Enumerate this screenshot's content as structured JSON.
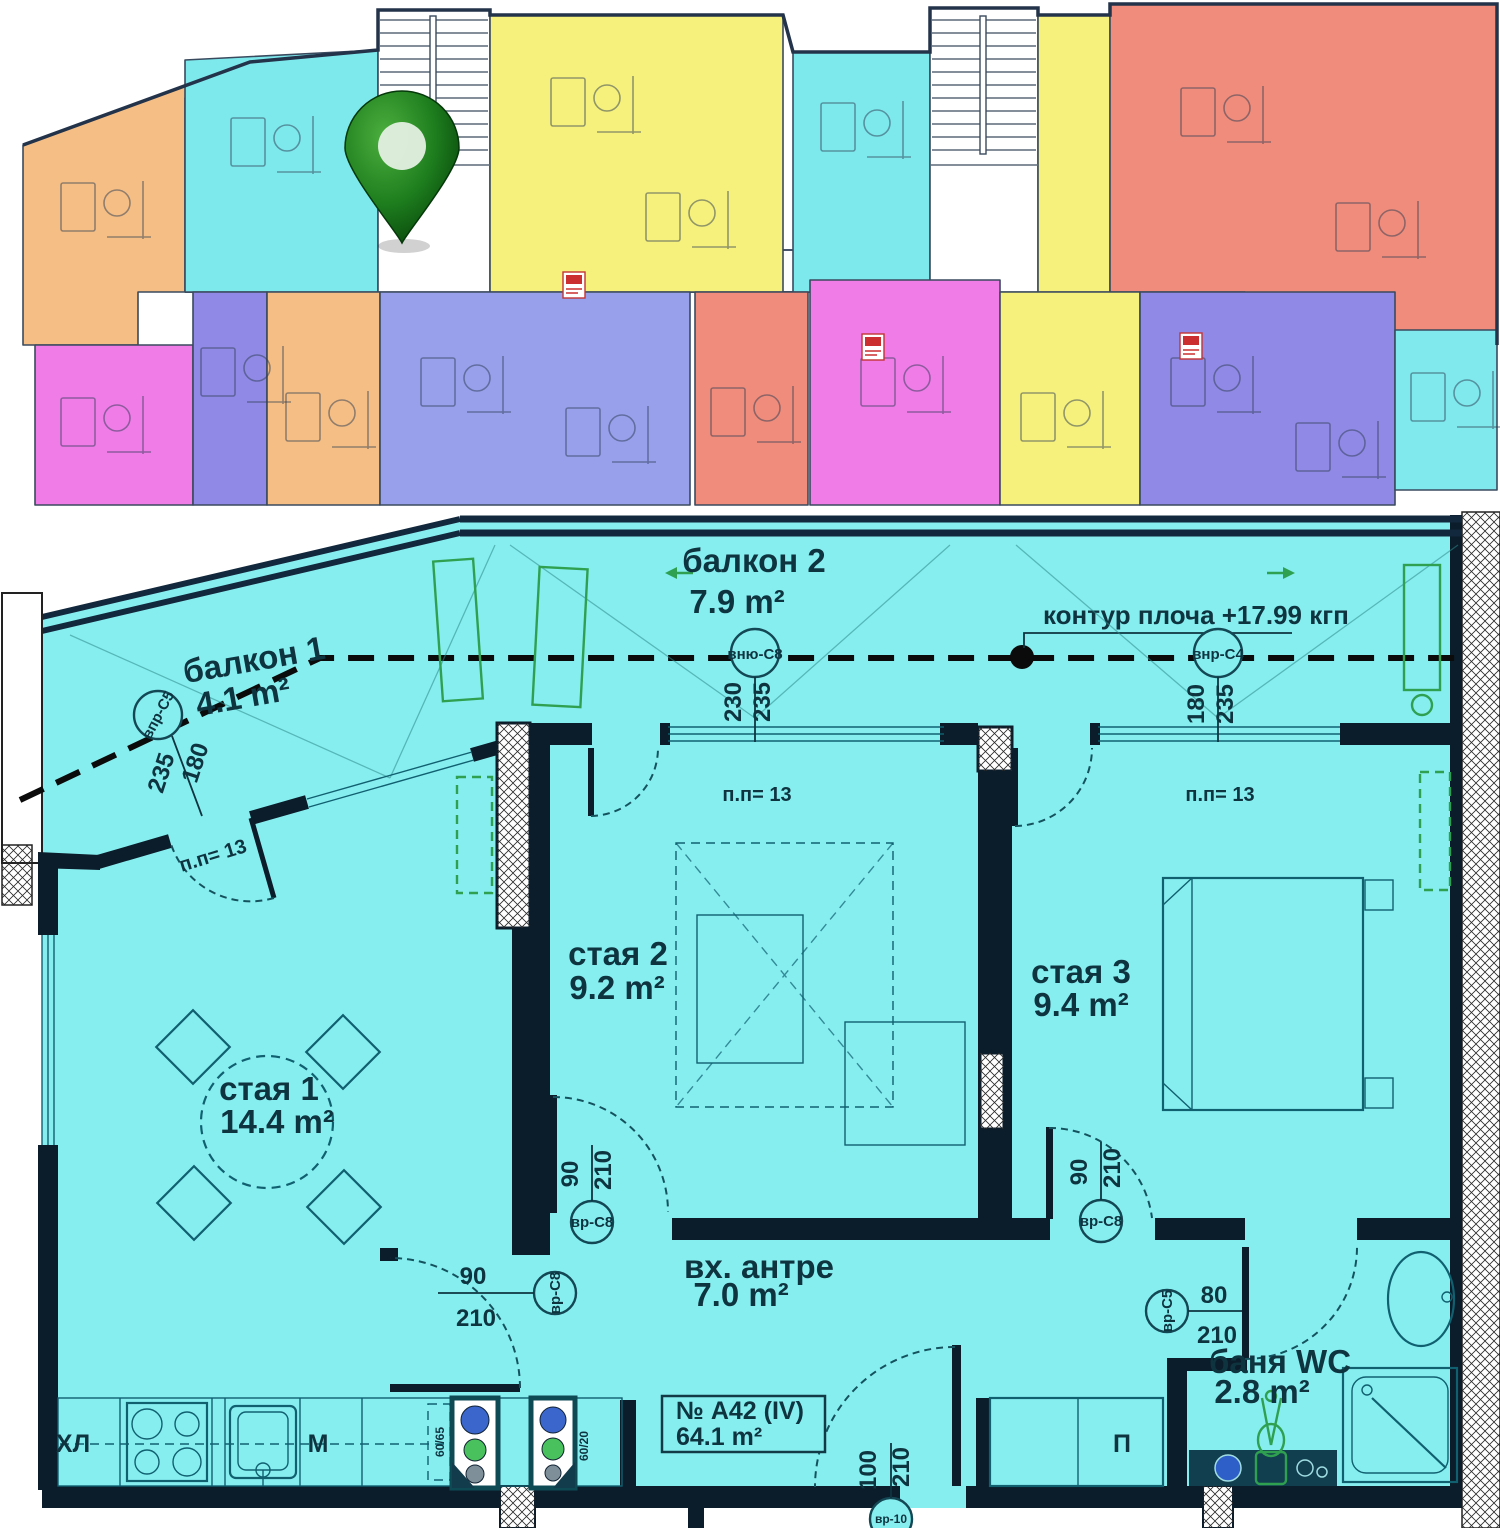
{
  "overview": {
    "colors": {
      "orange": "#F5BE85",
      "cyan": "#7EE9ED",
      "yellow": "#F6F17D",
      "salmon": "#F08C7B",
      "magenta": "#F07CE8",
      "purple": "#9089E6",
      "blue": "#98A0EC",
      "teal_right": "#7FE9ED"
    },
    "pin": {
      "name": "location-pin",
      "color": "#1E7E1E"
    }
  },
  "plan": {
    "colors": {
      "floor": "#87EEF0",
      "wall": "#0B1C2A",
      "green": "#2FA050"
    },
    "unit": {
      "number": "№ А42 (IV)",
      "area": "64.1 m²"
    },
    "slab_note": "контур плоча +17.99 кгп",
    "rooms": {
      "balcony1": {
        "name": "балкон 1",
        "area": "4.1 m²"
      },
      "balcony2": {
        "name": "балкон 2",
        "area": "7.9 m²"
      },
      "room1": {
        "name": "стая 1",
        "area": "14.4 m²"
      },
      "room2": {
        "name": "стая 2",
        "area": "9.2 m²"
      },
      "room3": {
        "name": "стая 3",
        "area": "9.4 m²"
      },
      "hall": {
        "name": "вх. антре",
        "area": "7.0 m²"
      },
      "bath": {
        "name": "баня WC",
        "area": "2.8 m²"
      }
    },
    "appliances": {
      "fridge": "ХЛ",
      "counter": "М",
      "wardrobe": "П"
    },
    "notes": {
      "pp13": "п.п= 13",
      "shaft1": "60/65",
      "shaft2": "60/20"
    },
    "windows": {
      "w1": {
        "tag": "впр-С5",
        "w": "180",
        "h": "235"
      },
      "w2": {
        "tag": "вню-С8",
        "w": "230",
        "h": "235"
      },
      "w3": {
        "tag": "внр-С4",
        "w": "180",
        "h": "235"
      }
    },
    "doors": {
      "d1": {
        "tag": "вр-С8",
        "w": "90",
        "h": "210"
      },
      "d2": {
        "tag": "вр-С8",
        "w": "90",
        "h": "210"
      },
      "d3": {
        "tag": "вр-С8",
        "w": "90",
        "h": "210"
      },
      "d4": {
        "tag": "вр-С5",
        "w": "80",
        "h": "210"
      },
      "d5": {
        "tag": "вр-10",
        "w": "100",
        "h": "210"
      }
    }
  }
}
